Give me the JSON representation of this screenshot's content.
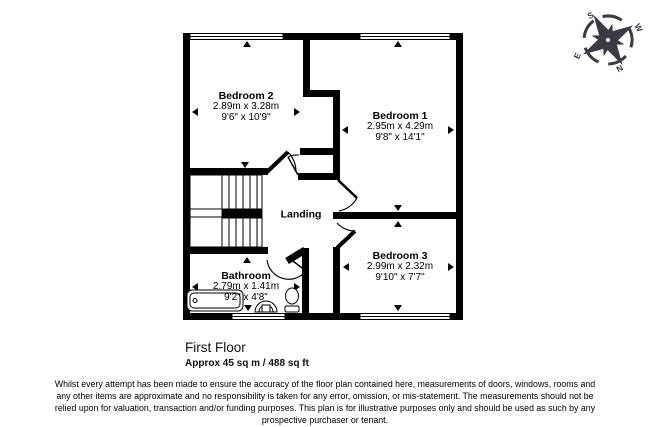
{
  "plan": {
    "title": "First Floor",
    "area": "Approx 45 sq m / 488 sq ft",
    "rooms": [
      {
        "name": "Bedroom 2",
        "metric": "2.89m x 3.28m",
        "imperial": "9'6\" x 10'9\""
      },
      {
        "name": "Bedroom 1",
        "metric": "2.95m x 4.29m",
        "imperial": "9'8\" x 14'1\""
      },
      {
        "name": "Bedroom 3",
        "metric": "2.99m x 2.32m",
        "imperial": "9'10\" x 7'7\""
      },
      {
        "name": "Bathroom",
        "metric": "2.79m x 1.41m",
        "imperial": "9'2\" x 4'8\""
      },
      {
        "name": "Landing"
      }
    ],
    "compass": {
      "top": "S",
      "upper_right": "W",
      "lower_right": "N",
      "left": "E"
    },
    "disclaimer_lines": [
      "Whilst every attempt has been made to ensure the accuracy of the floor plan contained here, measurements of doors, windows, rooms and",
      "any other items are approximate and no responsibility is taken for any error, omission, or mis-statement. The measurements should not be",
      "relied upon for valuation, transaction and/or funding purposes. This plan is for illustrative purposes only and should be used as such by any",
      "prospective purchaser or tenant."
    ],
    "colors": {
      "walls": "#000000",
      "compass": "#3b3b44",
      "background": "#ffffff",
      "text": "#000000"
    }
  }
}
